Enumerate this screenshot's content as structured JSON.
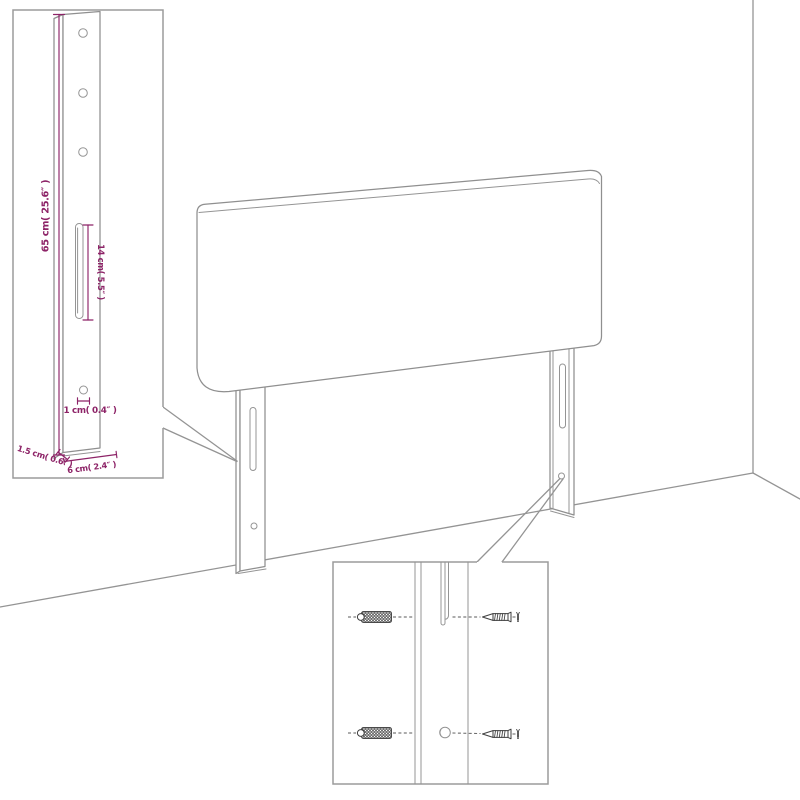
{
  "page": {
    "background": "#ffffff",
    "description": "Headboard wall-mounting assembly line diagram"
  },
  "colors": {
    "outline_gray": "#949494",
    "hardware_dark": "#3f3f3f",
    "dimension_purple": "#8d2367"
  },
  "leg_detail_inset": {
    "dim_height": "65 cm( 25.6″ )",
    "dim_slot_length": "14 cm( 5.5″ )",
    "dim_hole": "1 cm( 0.4″ )",
    "dim_depth": "1.5 cm( 0.6″ )",
    "dim_width": "6 cm( 2.4″ )",
    "icons": [
      "leg-front-icon",
      "screw-hole-icon",
      "keyhole-slot-icon"
    ]
  },
  "mount_detail_inset": {
    "icons": [
      "wall-plug-icon",
      "mounting-screw-icon",
      "screw-hole-icon",
      "keyhole-slot-icon"
    ]
  }
}
